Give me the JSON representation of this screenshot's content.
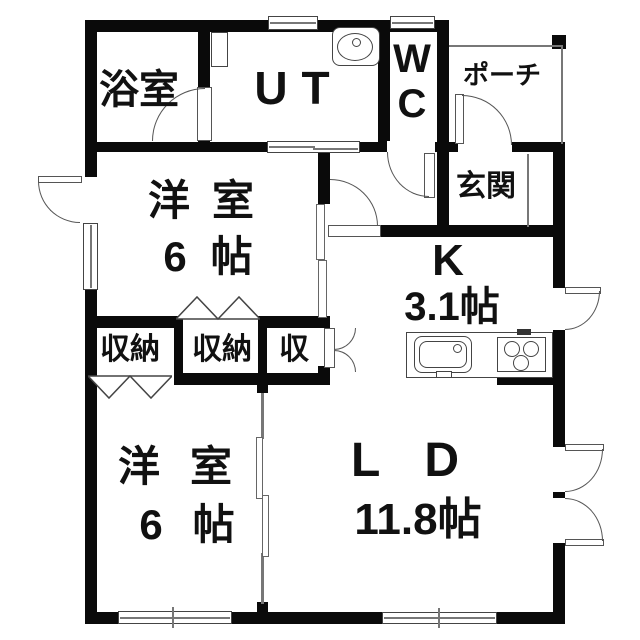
{
  "rooms": {
    "bath": {
      "label": "浴室"
    },
    "utility": {
      "label": "UT"
    },
    "wc": {
      "label": "WC"
    },
    "porch": {
      "label": "ポーチ"
    },
    "entrance": {
      "label": "玄関"
    },
    "bedroom1": {
      "label": "洋室",
      "size": "6帖"
    },
    "kitchen": {
      "label": "K",
      "size": "3.1帖"
    },
    "closet1": {
      "label": "収納"
    },
    "closet2": {
      "label": "収納"
    },
    "closet3": {
      "label": "収"
    },
    "bedroom2": {
      "label": "洋室",
      "size": "6帖"
    },
    "living": {
      "label": "LD",
      "size": "11.8帖"
    }
  },
  "colors": {
    "wall": "#0a0a0a",
    "line": "#666666",
    "background": "#ffffff",
    "text": "#111111"
  }
}
